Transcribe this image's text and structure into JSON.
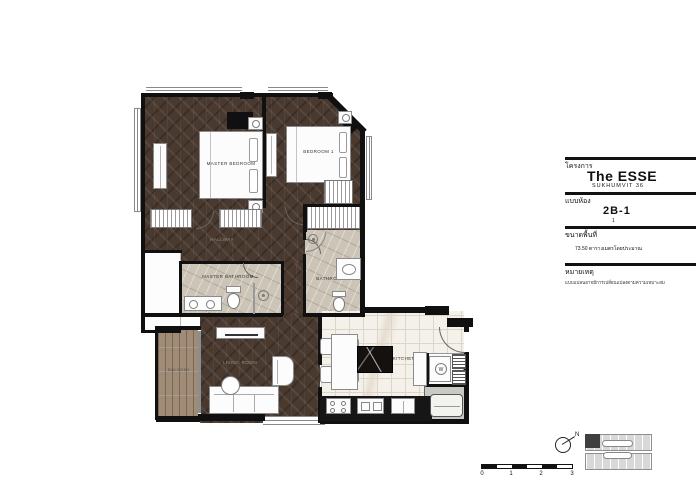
{
  "title_block": {
    "project_label_th": "โครงการ",
    "project_name": "The ESSE",
    "project_sub": "SUKHUMVIT 36",
    "unit_label_th": "แบบห้อง",
    "unit_type": "2B-1",
    "unit_sub": "1",
    "area_label_th": "ขนาดพื้นที่",
    "area_value_th": "73.50 ตารางเมตรโดยประมาณ",
    "remark_label_th": "หมายเหตุ",
    "remark_text_th": "แบบแปลนอาจมีการเปลี่ยนแปลงตามความเหมาะสม"
  },
  "rooms": {
    "master_bedroom": "MASTER BEDROOM",
    "bedroom1": "BEDROOM 1",
    "master_bathroom": "MASTER BATHROOM",
    "bathroom1": "BATHROOM 1",
    "kitchen": "KITCHEN",
    "living": "LIVING ROOM",
    "hallway": "HALLWAY",
    "balcony": "BALCONY"
  },
  "fixtures": {
    "washer_label": "W"
  },
  "scale_bar": {
    "labels": [
      "0",
      "1",
      "2",
      "3"
    ]
  },
  "compass": {
    "north_label": "N"
  },
  "colors": {
    "wall": "#101010",
    "wood_floor": "#49392f",
    "balcony_wood": "#a08b76",
    "bathroom_marble": "#ccc4b6",
    "kitchen_floor": "#f4f1ea",
    "keyplan_gray": "#d8d8d8"
  }
}
